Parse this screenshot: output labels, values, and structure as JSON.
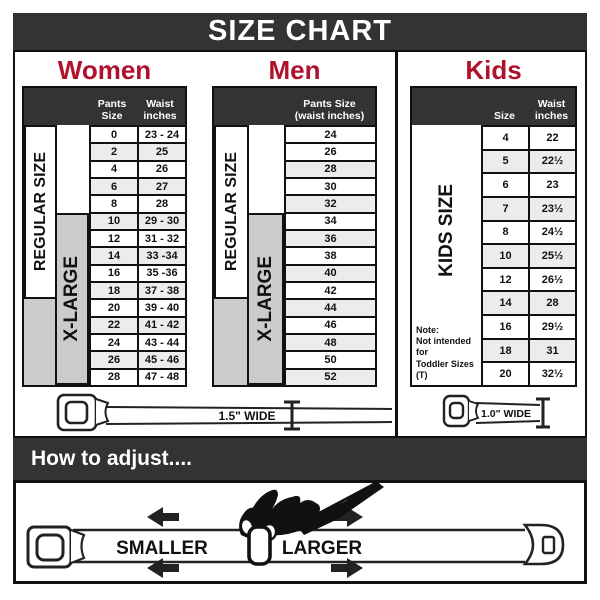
{
  "title": "SIZE CHART",
  "colors": {
    "accent_red": "#b0122c",
    "bar_dark": "#333333",
    "xlarge_gray": "#cbcbcb",
    "row_alt": "#ececec"
  },
  "women": {
    "title": "Women",
    "headers": {
      "size": "Pants Size",
      "waist": "Waist\ninches"
    },
    "labels": {
      "regular": "REGULAR SIZE",
      "xlarge": "X-LARGE"
    },
    "rows": [
      {
        "size": "0",
        "waist": "23 - 24"
      },
      {
        "size": "2",
        "waist": "25"
      },
      {
        "size": "4",
        "waist": "26"
      },
      {
        "size": "6",
        "waist": "27"
      },
      {
        "size": "8",
        "waist": "28"
      },
      {
        "size": "10",
        "waist": "29 - 30"
      },
      {
        "size": "12",
        "waist": "31 - 32"
      },
      {
        "size": "14",
        "waist": "33 -34"
      },
      {
        "size": "16",
        "waist": "35 -36"
      },
      {
        "size": "18",
        "waist": "37 - 38"
      },
      {
        "size": "20",
        "waist": "39 - 40"
      },
      {
        "size": "22",
        "waist": "41 - 42"
      },
      {
        "size": "24",
        "waist": "43 - 44"
      },
      {
        "size": "26",
        "waist": "45 - 46"
      },
      {
        "size": "28",
        "waist": "47 - 48"
      }
    ]
  },
  "men": {
    "title": "Men",
    "headers": {
      "size": "Pants Size\n(waist inches)"
    },
    "labels": {
      "regular": "REGULAR SIZE",
      "xlarge": "X-LARGE"
    },
    "rows": [
      {
        "size": "24"
      },
      {
        "size": "26"
      },
      {
        "size": "28"
      },
      {
        "size": "30"
      },
      {
        "size": "32"
      },
      {
        "size": "34"
      },
      {
        "size": "36"
      },
      {
        "size": "38"
      },
      {
        "size": "40"
      },
      {
        "size": "42"
      },
      {
        "size": "44"
      },
      {
        "size": "46"
      },
      {
        "size": "48"
      },
      {
        "size": "50"
      },
      {
        "size": "52"
      }
    ]
  },
  "kids": {
    "title": "Kids",
    "headers": {
      "size": "Size",
      "waist": "Waist\ninches"
    },
    "labels": {
      "kids": "KIDS SIZE"
    },
    "note": "Note:\nNot intended for\nToddler Sizes (T)",
    "rows": [
      {
        "size": "4",
        "waist": "22"
      },
      {
        "size": "5",
        "waist": "22½"
      },
      {
        "size": "6",
        "waist": "23"
      },
      {
        "size": "7",
        "waist": "23½"
      },
      {
        "size": "8",
        "waist": "24½"
      },
      {
        "size": "10",
        "waist": "25½"
      },
      {
        "size": "12",
        "waist": "26½"
      },
      {
        "size": "14",
        "waist": "28"
      },
      {
        "size": "16",
        "waist": "29½"
      },
      {
        "size": "18",
        "waist": "31"
      },
      {
        "size": "20",
        "waist": "32½"
      }
    ]
  },
  "belts": {
    "adult_width": "1.5\" WIDE",
    "kids_width": "1.0\" WIDE"
  },
  "adjust": {
    "title": "How to adjust....",
    "smaller": "SMALLER",
    "larger": "LARGER"
  }
}
